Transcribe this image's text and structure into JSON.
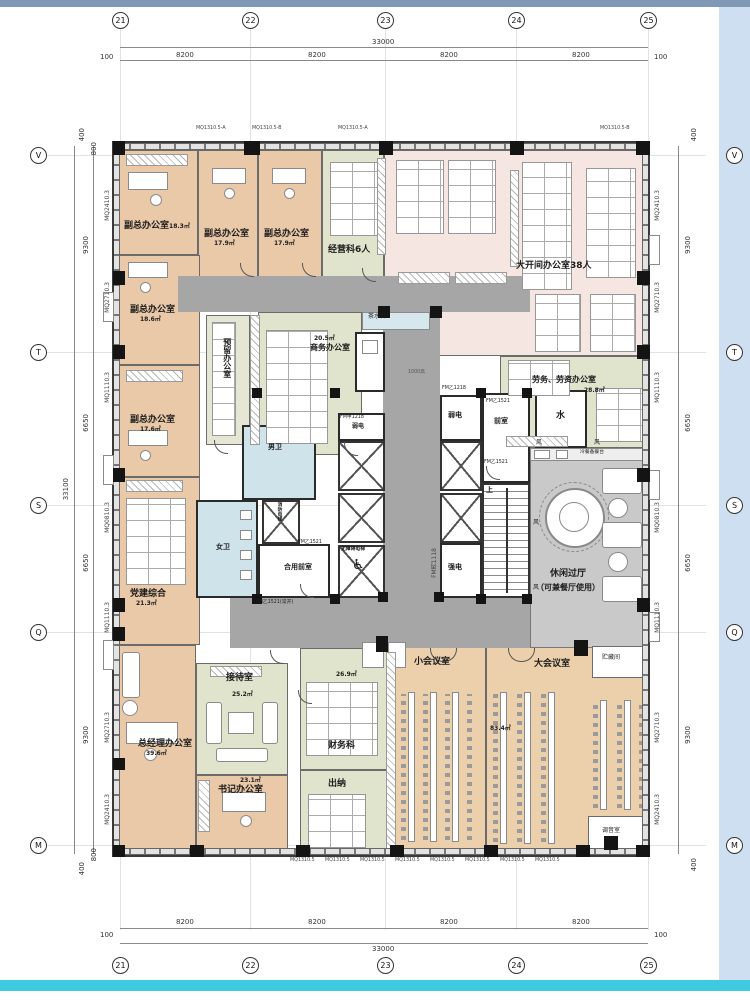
{
  "frame": {
    "top_bar_color": "#7f98b6",
    "side_band_color": "#cfdff2",
    "bottom_bar_color": "#3ecbe2"
  },
  "axes": {
    "top_bubbles": [
      "21",
      "22",
      "23",
      "24",
      "25"
    ],
    "side_bubbles": [
      "V",
      "T",
      "S",
      "Q",
      "M"
    ],
    "dim_overall_h": "33000",
    "dim_seg_h": "8200",
    "dim_end_h": "100",
    "dim_overall_v": "33100",
    "dim_seg_v_a": "9300",
    "dim_seg_v_b": "6650",
    "dim_small_a": "400",
    "dim_small_b": "800"
  },
  "wall_codes": {
    "side": [
      "MQ2410.3",
      "MQ2710.3",
      "MQ1110.3",
      "MQ0810.3",
      "MQ1110.3",
      "MQ2710.3",
      "MQ2410.3"
    ],
    "top_a": "MQ1310.5-A",
    "top_b": "MQ1310.5-B",
    "bottom": "MQ1310.5"
  },
  "rooms": {
    "vice1": {
      "label": "副总办公室",
      "area": "18.3㎡"
    },
    "vice2": {
      "label": "副总办公室",
      "area": "17.9㎡"
    },
    "vice3": {
      "label": "副总办公室",
      "area": "17.9㎡"
    },
    "jingying": {
      "label": "经营科6人"
    },
    "dakaijian": {
      "label": "大开间办公室38人"
    },
    "laowu": {
      "label": "劳务、劳资办公室",
      "area": "28.8㎡"
    },
    "vice4": {
      "label": "副总办公室",
      "area": "18.6㎡"
    },
    "vice5": {
      "label": "副总办公室",
      "area": "17.6㎡"
    },
    "yuliu": {
      "label": "预留办公室"
    },
    "shangwu": {
      "label": "商务办公室",
      "area": "20.5㎡"
    },
    "dangjian": {
      "label": "党建综合",
      "area": "21.3㎡"
    },
    "zongjingli": {
      "label": "总经理办公室",
      "area": "39.6㎡"
    },
    "jiedai": {
      "label": "接待室",
      "area": "25.2㎡"
    },
    "shuji": {
      "label": "书记办公室",
      "area": "23.1㎡"
    },
    "caiwu": {
      "label": "财务科",
      "area": "26.9㎡"
    },
    "chuna": {
      "label": "出纳"
    },
    "xiaohui": {
      "label": "小会议室"
    },
    "dahui": {
      "label": "大会议室",
      "area": "83.4㎡"
    },
    "xiuxian": {
      "label": "休闲过厅",
      "sub": "（可兼餐厅使用）"
    },
    "zhucang": {
      "label": "贮藏间"
    },
    "tiaoyin": {
      "label": "调音室"
    }
  },
  "core": {
    "nanwei": "男卫",
    "nvwei": "女卫",
    "qianshi": "前室",
    "heyong": "合用前室",
    "ruodian": "弱电",
    "qiangdian": "强电",
    "shui": "水",
    "feng": "风",
    "wuzhangai": "无障碍电梯",
    "xiaofang": "消防电梯",
    "shang": "上",
    "chashuitai": "茶水台",
    "lengcan": "冷餐备餐台",
    "h1000": "1000高"
  },
  "doors": {
    "fm_y1521": "FM乙1521",
    "fm_y1521k": "FM乙1521(常开)",
    "fm_j1218": "FM甲1218",
    "fm_b1118": "FM丙1118",
    "fm_y1218": "FM乙1218"
  },
  "icons": {
    "wheelchair": "♿"
  }
}
